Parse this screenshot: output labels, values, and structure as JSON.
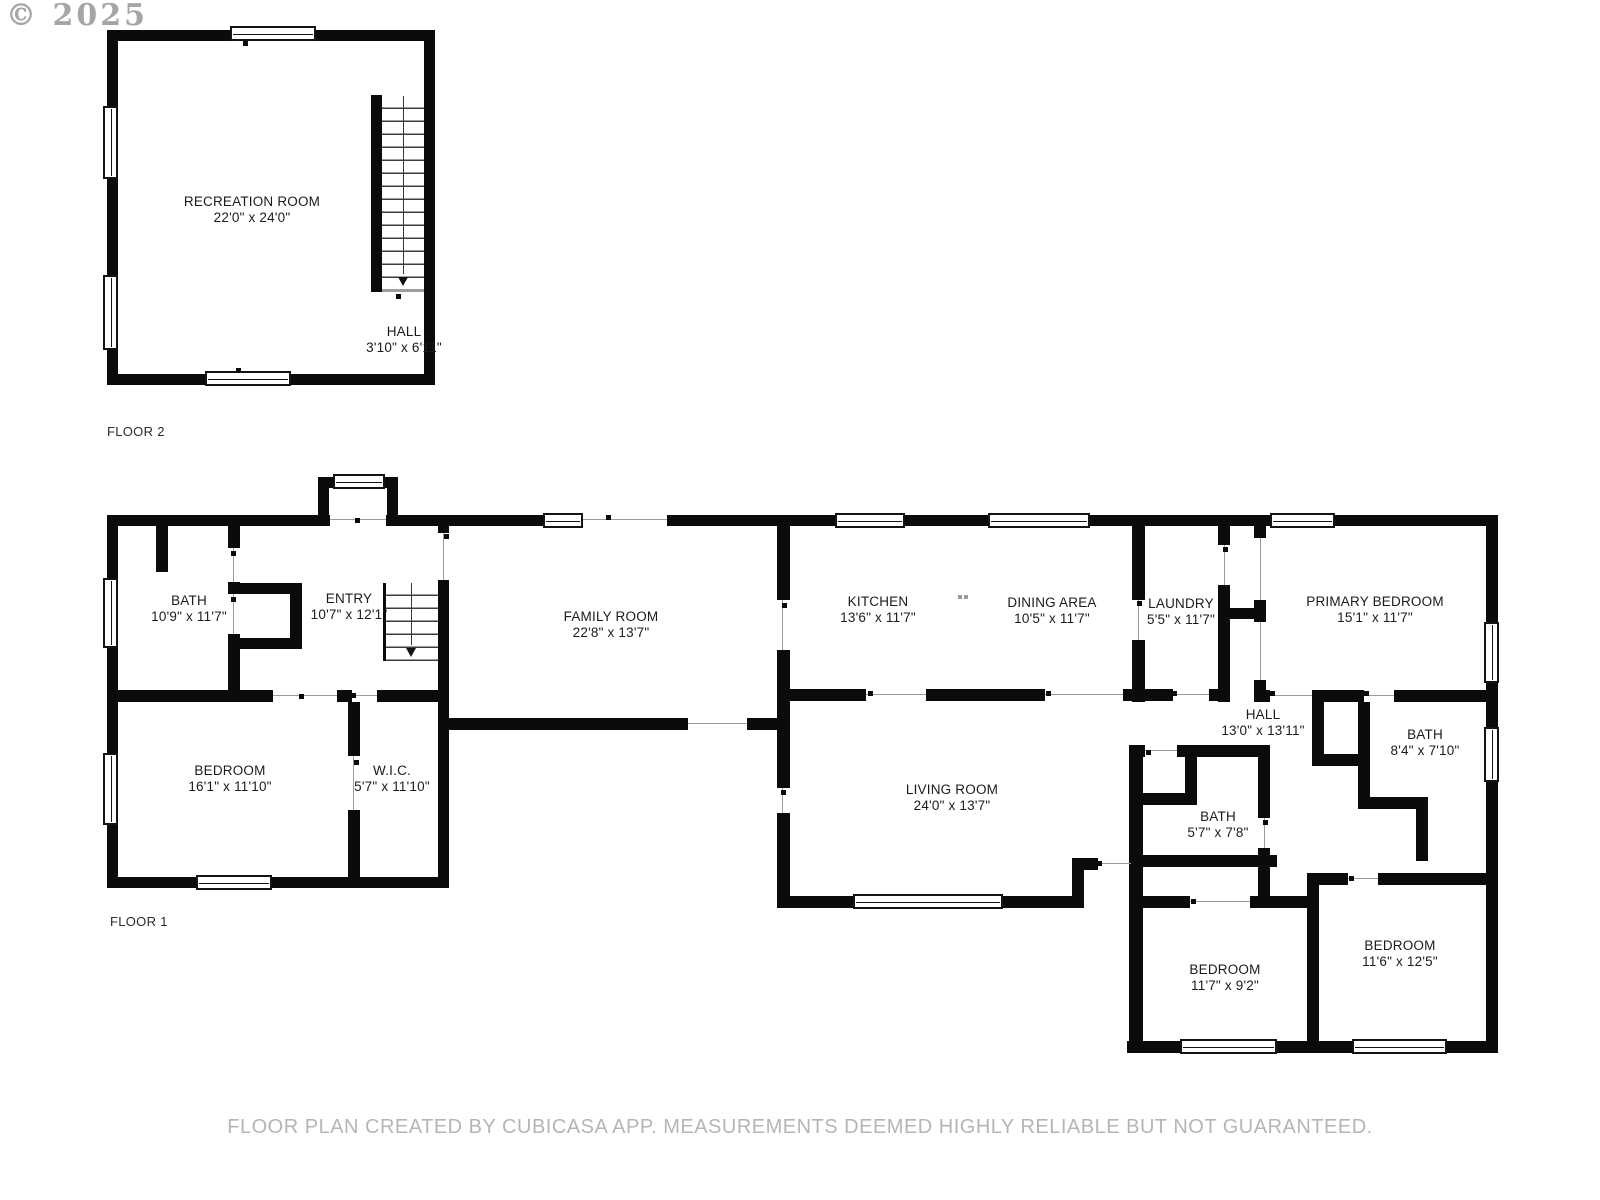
{
  "watermark": {
    "copyright": "© 2025"
  },
  "footer": {
    "disclaimer": "FLOOR PLAN CREATED BY CUBICASA APP. MEASUREMENTS DEEMED HIGHLY RELIABLE BUT NOT GUARANTEED."
  },
  "floors": [
    {
      "label": "FLOOR 2",
      "rooms": [
        {
          "name": "RECREATION ROOM",
          "dims": "22'0\" x 24'0\""
        },
        {
          "name": "HALL",
          "dims": "3'10\" x 6'11\""
        }
      ]
    },
    {
      "label": "FLOOR 1",
      "rooms": [
        {
          "name": "BATH",
          "dims": "10'9\" x 11'7\""
        },
        {
          "name": "ENTRY",
          "dims": "10'7\" x 12'1\""
        },
        {
          "name": "FAMILY ROOM",
          "dims": "22'8\" x 13'7\""
        },
        {
          "name": "KITCHEN",
          "dims": "13'6\" x 11'7\""
        },
        {
          "name": "DINING AREA",
          "dims": "10'5\" x 11'7\""
        },
        {
          "name": "LAUNDRY",
          "dims": "5'5\" x 11'7\""
        },
        {
          "name": "PRIMARY BEDROOM",
          "dims": "15'1\" x 11'7\""
        },
        {
          "name": "BEDROOM",
          "dims": "16'1\" x 11'10\""
        },
        {
          "name": "W.I.C.",
          "dims": "5'7\" x 11'10\""
        },
        {
          "name": "LIVING ROOM",
          "dims": "24'0\" x 13'7\""
        },
        {
          "name": "HALL",
          "dims": "13'0\" x 13'11\""
        },
        {
          "name": "BATH",
          "dims": "8'4\" x 7'10\""
        },
        {
          "name": "BATH",
          "dims": "5'7\" x 7'8\""
        },
        {
          "name": "BEDROOM",
          "dims": "11'7\" x 9'2\""
        },
        {
          "name": "BEDROOM",
          "dims": "11'6\" x 12'5\""
        }
      ]
    }
  ]
}
